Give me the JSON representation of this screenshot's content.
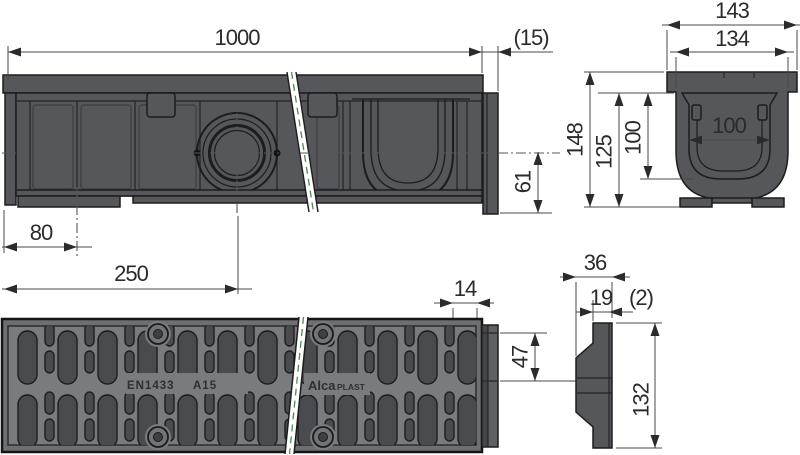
{
  "side_view": {
    "length": "1000",
    "end_cap_overhang": "(15)",
    "outlet_axis_to_bottom": "61",
    "left_edge_to_support": "80",
    "left_edge_to_outlet": "250"
  },
  "cross_section": {
    "overall_width": "143",
    "body_width": "134",
    "inner_width": "100",
    "overall_height": "148",
    "body_height": "125",
    "inner_depth": "100"
  },
  "grate_view": {
    "standard_marking": "EN1433",
    "load_class": "A15",
    "brand_name": "Alca",
    "brand_suffix": "PLAST",
    "end_profile_width": "14",
    "end_profile_upper_height": "47"
  },
  "end_cap_view": {
    "overall_width": "36",
    "rib_width": "19",
    "lip_thickness": "(2)",
    "height": "132"
  },
  "colors": {
    "body_gray": "#56575a",
    "outline": "#1d1d1f",
    "grate_face": "#7a7b7e",
    "slot_fill": "#4a4b4e",
    "break_line_green": "#4e8a58",
    "dimension": "#2b2b2d",
    "background": "#ffffff"
  }
}
